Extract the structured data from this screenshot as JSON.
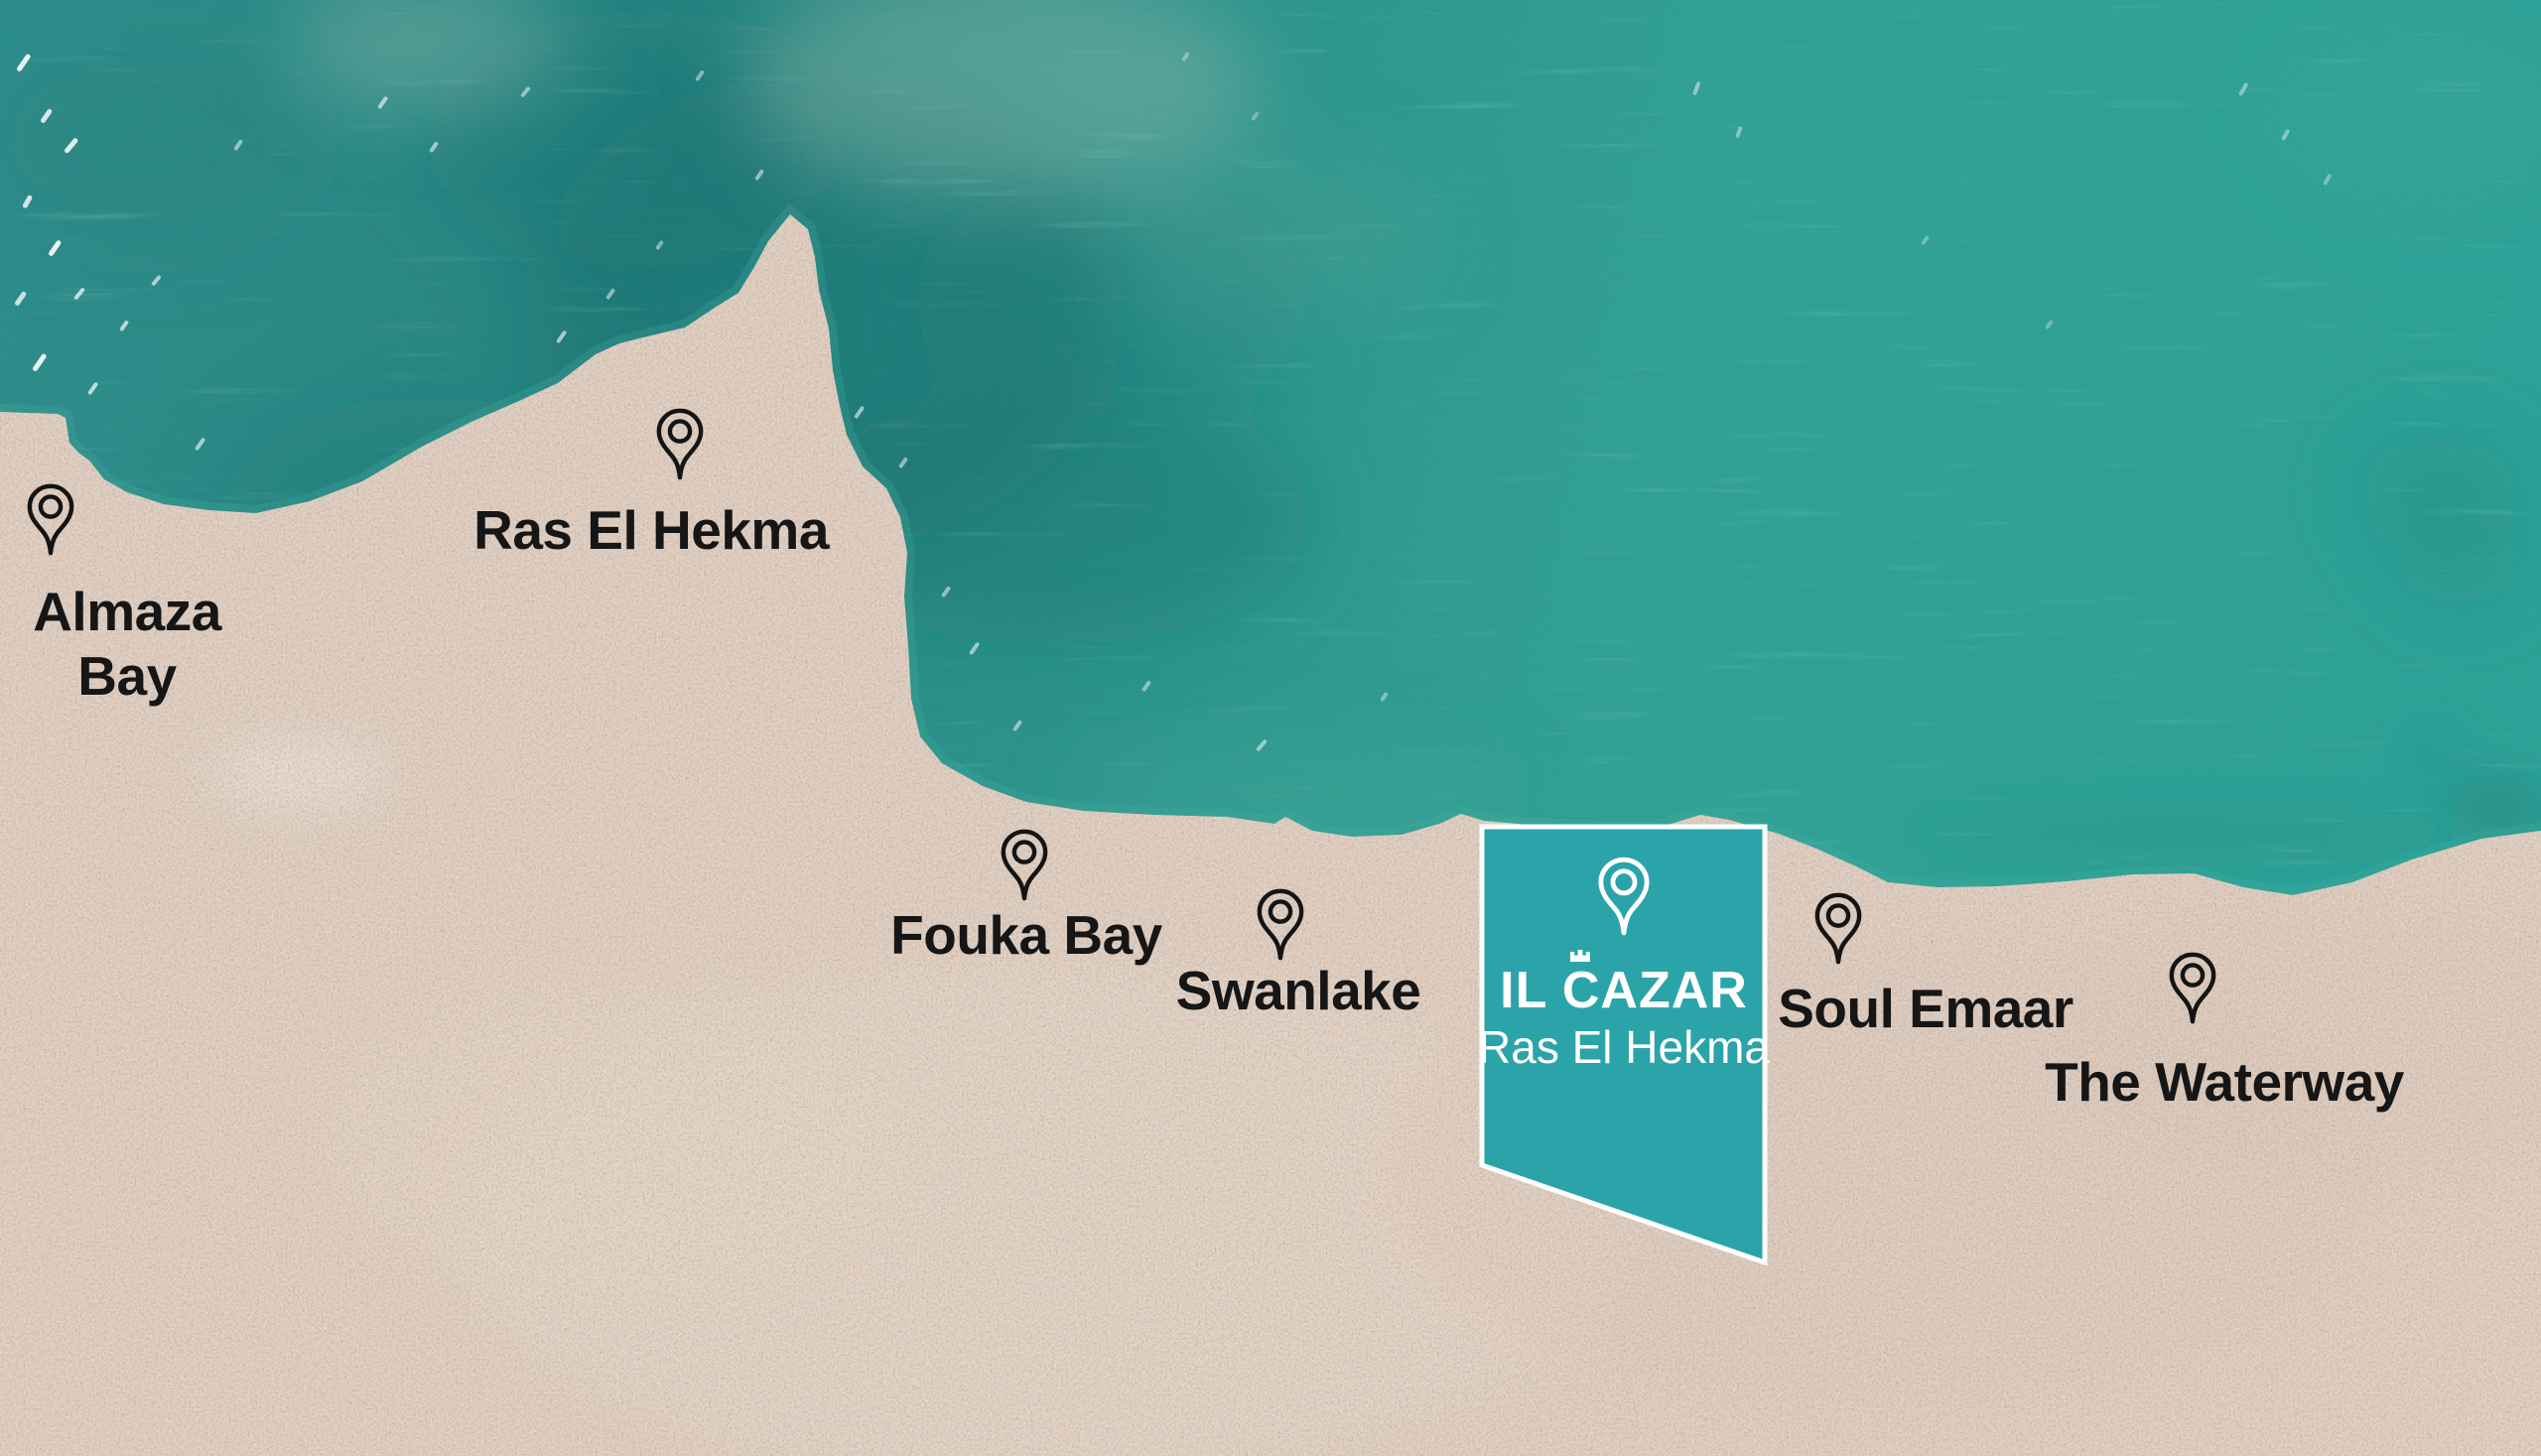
{
  "map": {
    "locations": [
      {
        "id": "almaza-bay",
        "label": "Almaza Bay"
      },
      {
        "id": "ras-el-hekma",
        "label": "Ras El Hekma"
      },
      {
        "id": "fouka-bay",
        "label": "Fouka Bay"
      },
      {
        "id": "swanlake",
        "label": "Swanlake"
      },
      {
        "id": "soul-emaar",
        "label": "Soul Emaar"
      },
      {
        "id": "the-waterway",
        "label": "The Waterway"
      }
    ],
    "banner": {
      "brand": "IL CAZAR",
      "subtitle": "Ras El Hekma"
    },
    "colors": {
      "sea_dark": "#176e70",
      "sea_base": "#2a938c",
      "sea_light": "#35a89b",
      "sand": "#dccabc",
      "banner_teal": "#2ba4a9",
      "banner_border": "#ffffff",
      "banner_text": "#ffffff",
      "label_text": "#161616",
      "pin_black": "#141414",
      "pin_white": "#ffffff"
    }
  }
}
